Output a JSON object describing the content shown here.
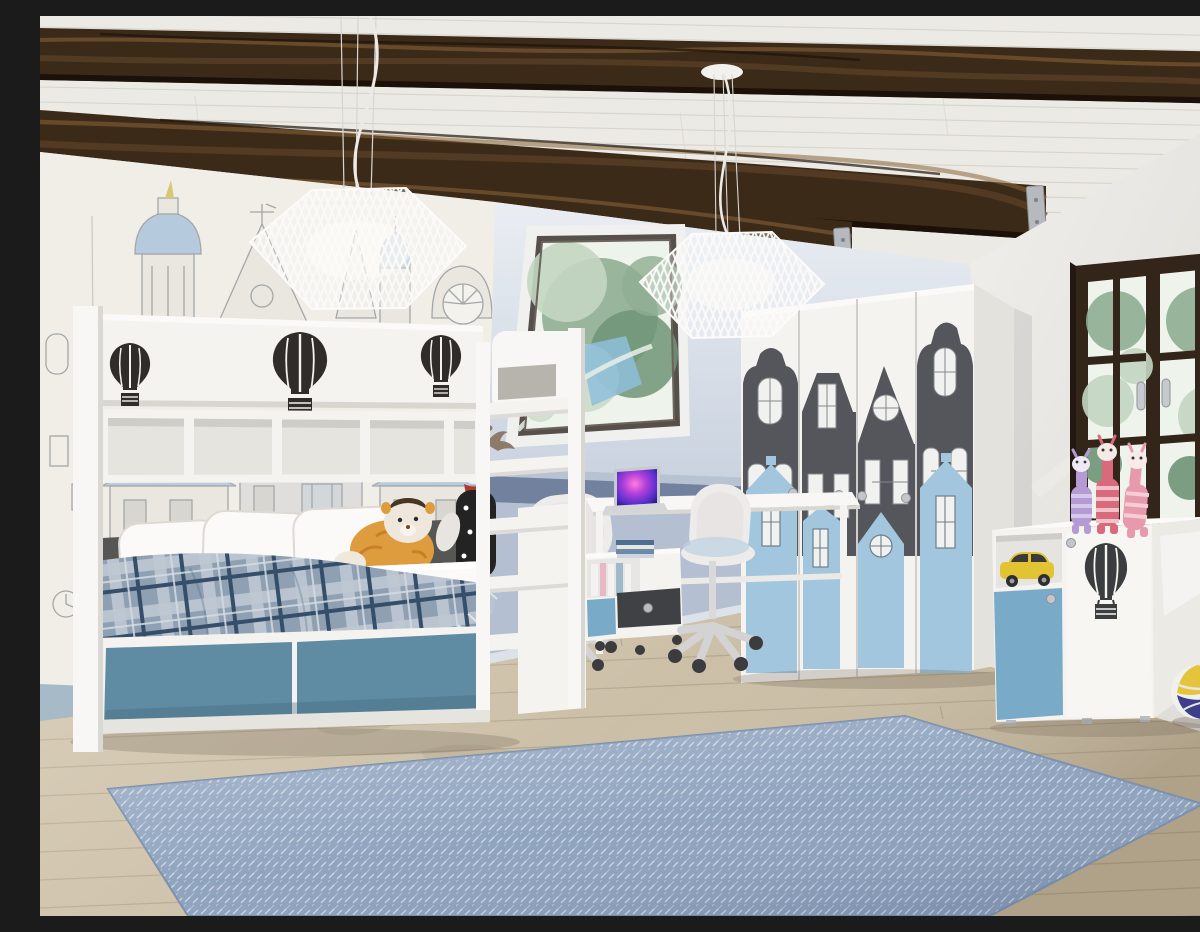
{
  "meta": {
    "description": "3D render of a children's attic bedroom: white loft bed with hot-air-balloon cutouts and blue drawers, sketched old-town mural wall, slanted ceiling with rustic dark wood beams and skylight, desk with laptop and two white swivel chairs, wardrobe with Amsterdam canal-house silhouettes, blue-and-white sideboard with plush giraffes and a volleyball, light wood floor with a blue herringbone rug",
    "render_style": "photorealistic interior visualization",
    "visible_text": "none"
  },
  "palette": {
    "ceiling_white": "#eceae5",
    "ceiling_line": "#d7d4cd",
    "beam_dark": "#3c2a18",
    "beam_mid": "#5d4226",
    "beam_light": "#8a6538",
    "beam_gap": "#1c1108",
    "bracket_gray": "#b6b9bd",
    "mural_bg": "#f1eee7",
    "mural_line": "#a3a7a9",
    "mural_blue": "#b5cadd",
    "mural_accent": "#d9c873",
    "mural_fill": "#e9e7e0",
    "attic_wall_top": "#eaeef3",
    "attic_wall_bottom": "#c9d2df",
    "desk_wall": "#b7c2d3",
    "wall_stripe": "#72819e",
    "baseboard_blue": "#a7bac8",
    "right_wall": "#eae9e6",
    "window_frame": "#33251a",
    "window_glass": "#eef3ec",
    "foliage": "#8fae92",
    "foliage_dark": "#6f9477",
    "foliage_light": "#c3d6c2",
    "sky_glimpse": "#8fc0da",
    "floor_wood": "#c9bca4",
    "floor_line": "#ab9d84",
    "rug_blue": "#8da2be",
    "rug_weave": "#e2e7f0",
    "furniture_white": "#f4f3f0",
    "furniture_bright": "#f8f7f5",
    "furniture_shade": "#dddbd6",
    "accent_teal": "#5f8ca3",
    "wardrobe_blue": "#a2c6de",
    "sideboard_blue": "#79abc9",
    "house_gray": "#54565b",
    "decor_dark": "#2f2c29",
    "backrest_gray": "#565654",
    "mattress_white": "#fbfaf8",
    "plaid_base": "#9aabbe",
    "plaid_light": "#cfd8e2",
    "plaid_dark": "#36506b",
    "chair_white": "#edecea",
    "metal_gray": "#c6c9cd",
    "screen_pink": "#ff7ae0",
    "screen_purple": "#7a35d6",
    "screen_deep": "#241a6e",
    "toy_yellow": "#e2c333",
    "plush_orange": "#df9c3f",
    "plush_purple": "#b59bd4",
    "plush_red": "#d96a7c",
    "plush_pink": "#e79aab",
    "ball_navy": "#3d3f8c",
    "ball_yellow": "#e5c43c"
  },
  "scene": {
    "room": "attic children's bedroom",
    "objects": [
      {
        "name": "ceiling",
        "description": "white plank ceiling with three rustic dark timber beams fixed to the wall with steel brackets"
      },
      {
        "name": "pendant-lamp-left",
        "description": "white slatted geometric pendant lamp on long cords"
      },
      {
        "name": "pendant-lamp-right",
        "description": "white slatted geometric pendant lamp with ceiling rose"
      },
      {
        "name": "mural-wall",
        "description": "wall with hand-sketched old European town mural, pale blue roofs and domes"
      },
      {
        "name": "skylight-window",
        "description": "slanted roof window showing green tree foliage"
      },
      {
        "name": "loft-bed",
        "description": "white loft bed with three dark hot-air-balloon cutouts, open cubby shelf, white pillows, plaid blanket, two blue drawers and a ladder"
      },
      {
        "name": "plush-lion",
        "description": "orange plush lion-giraffe toy on the bed"
      },
      {
        "name": "plush-deer",
        "description": "black and white plush deer with antlers on the bed"
      },
      {
        "name": "desk",
        "description": "white desk with open laptop and rolling drawer unit with books"
      },
      {
        "name": "desk-chairs",
        "description": "two white swivel chairs on casters"
      },
      {
        "name": "wardrobe",
        "description": "four-door wardrobe decorated with dark gray and light blue Amsterdam house silhouettes and round knobs"
      },
      {
        "name": "sideboard",
        "description": "white sideboard with blue door, dark balloon appliqué, yellow toy car on open shelf"
      },
      {
        "name": "plush-giraffes",
        "description": "three striped plush giraffes (purple, red, pink) standing on the sideboard"
      },
      {
        "name": "volleyball",
        "description": "blue, yellow and white volleyball on the floor"
      },
      {
        "name": "casement-window",
        "description": "dark brown double casement window with muntin bars and silver handles, greenery outside"
      },
      {
        "name": "herringbone-rug",
        "description": "large blue-gray herringbone weave rug"
      },
      {
        "name": "wooden-floor",
        "description": "light oak plank floor"
      }
    ]
  }
}
